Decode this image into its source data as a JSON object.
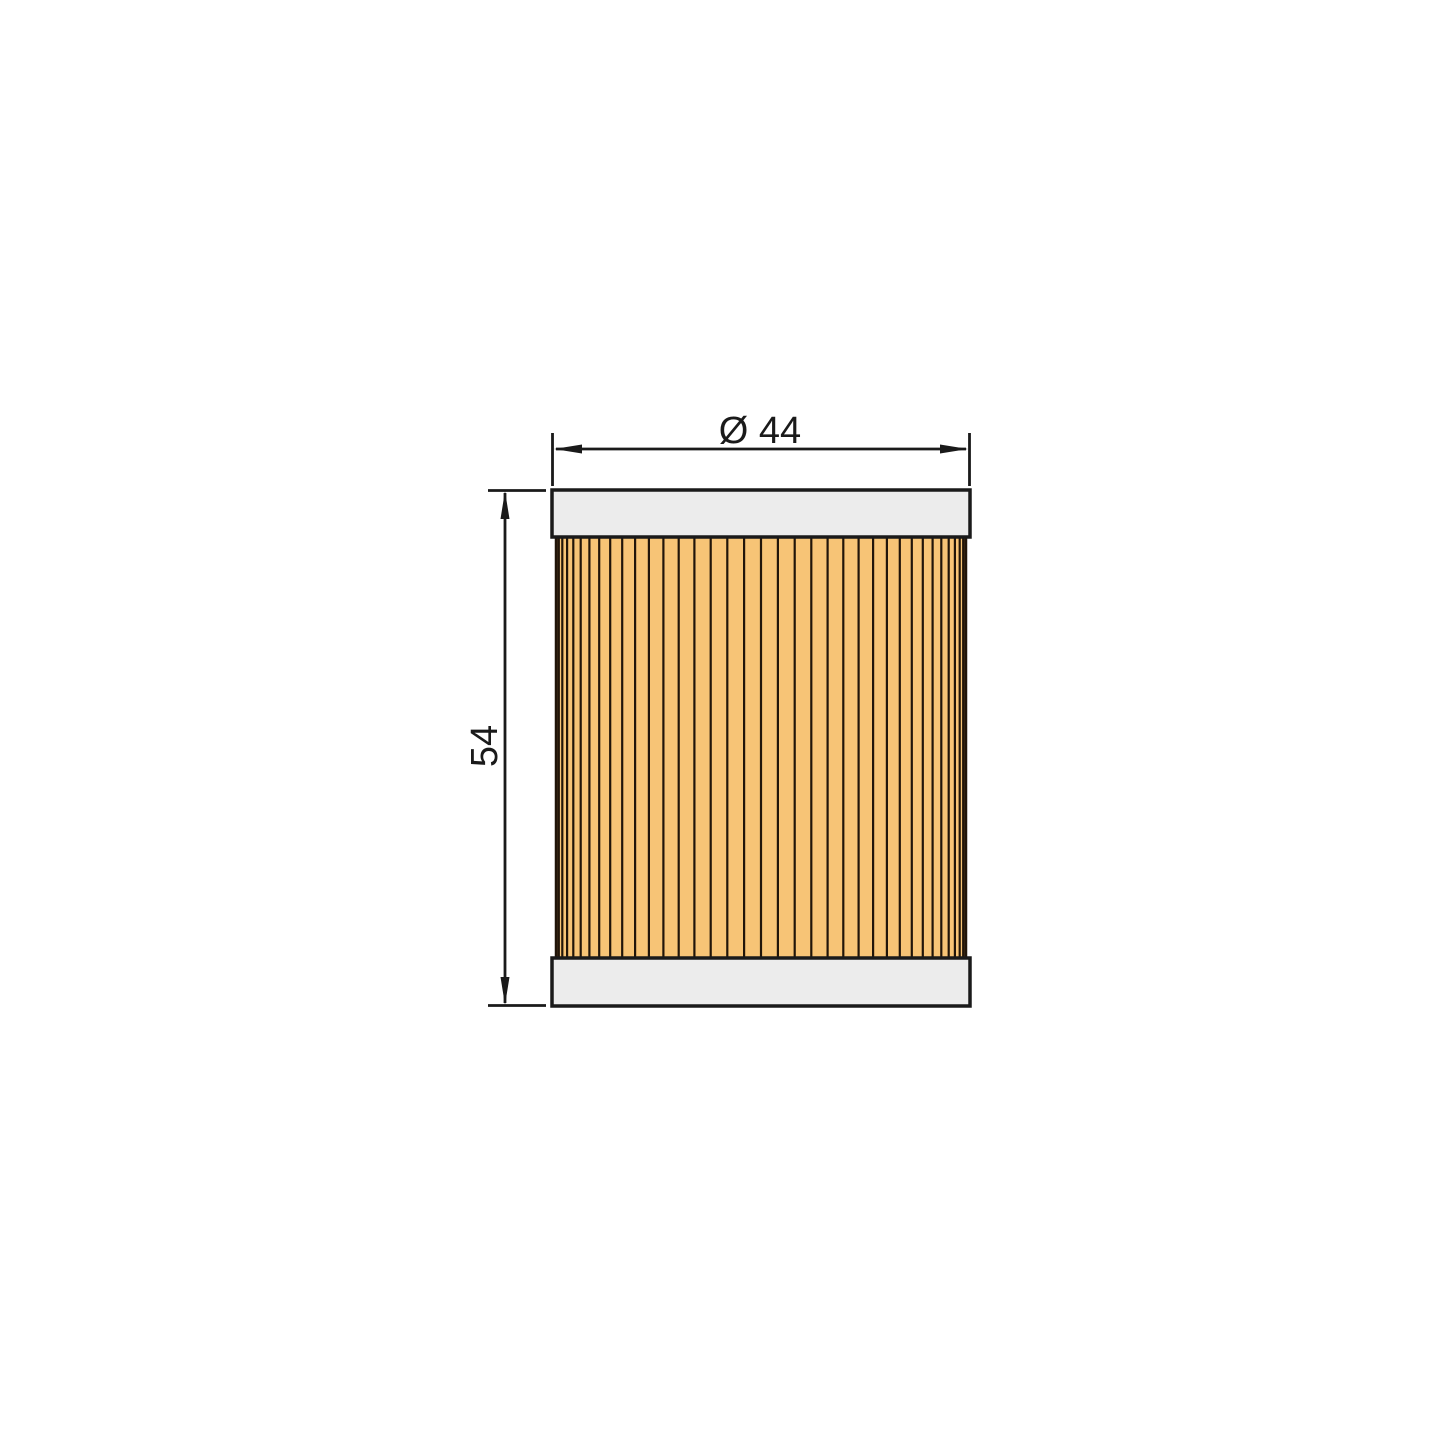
{
  "drawing": {
    "dimensions": {
      "diameter_label": "Ø 44",
      "height_label": "54"
    },
    "pleats": {
      "segments": 38
    },
    "colors": {
      "background": "#ffffff",
      "line": "#1a1a1a",
      "cap_fill": "#ececec",
      "pleat_fill": "#f7c476",
      "pleat_line": "#211509"
    }
  }
}
